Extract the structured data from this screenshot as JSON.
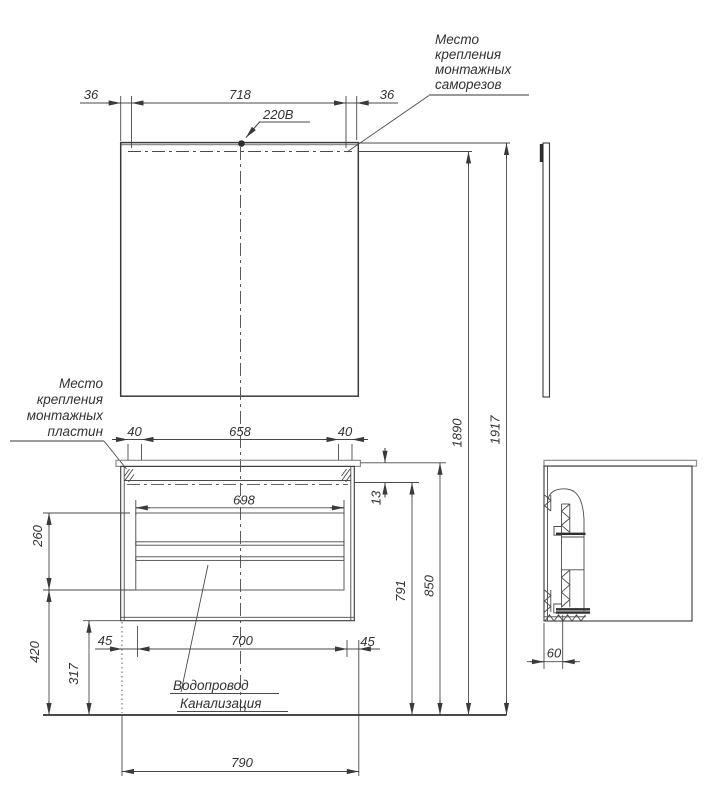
{
  "notes": {
    "screws": [
      "Место",
      "крепления",
      "монтажных",
      "саморезов"
    ],
    "plates": [
      "Место",
      "крепления",
      "монтажных",
      "пластин"
    ],
    "plumbing": [
      "Водопровод",
      "Канализация"
    ],
    "power": "220В"
  },
  "dims": {
    "mirror_margin_left": "36",
    "mirror_span": "718",
    "mirror_margin_right": "36",
    "plate_offset_left": "40",
    "plate_span": "658",
    "plate_offset_right": "40",
    "inner_width": "698",
    "top_rail": "13",
    "drawer_zone": "260",
    "floor_gap": "420",
    "bottom_clearance": "317",
    "service_offset_left": "45",
    "service_span": "700",
    "service_offset_right": "45",
    "cabinet_height": "791",
    "counter_height": "850",
    "mount_height": "1890",
    "total_height": "1917",
    "total_width": "790",
    "side_depth": "60"
  }
}
